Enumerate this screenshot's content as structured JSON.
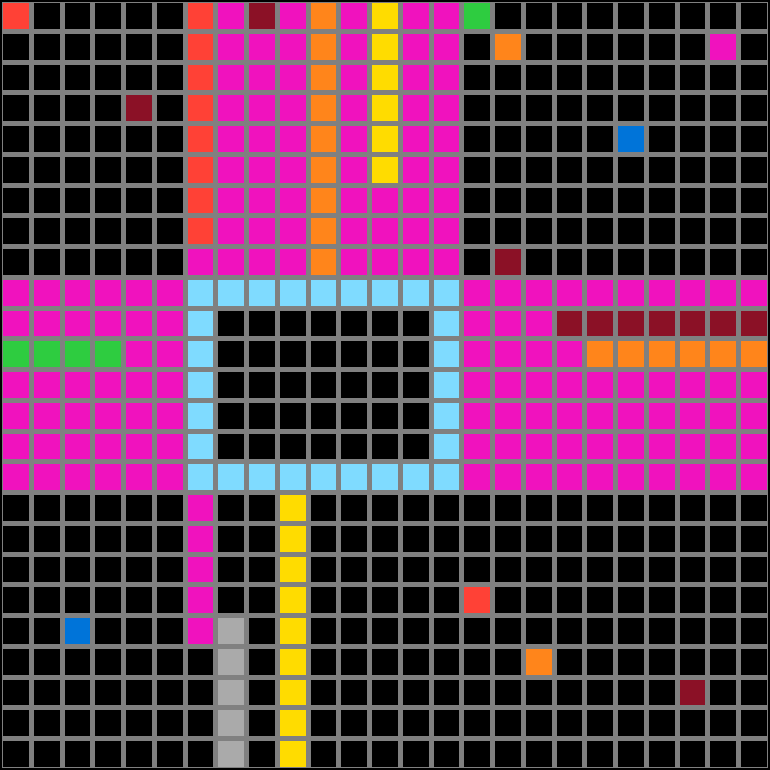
{
  "grid": {
    "columns": 25,
    "rows": 25,
    "line_color": "#808080",
    "outer_edge_color": "#000000",
    "palette": {
      "K": {
        "name": "black",
        "hex": "#000000"
      },
      "M": {
        "name": "magenta",
        "hex": "#F012BE"
      },
      "R": {
        "name": "red",
        "hex": "#FF4136"
      },
      "D": {
        "name": "dark-red",
        "hex": "#8B1126"
      },
      "O": {
        "name": "orange",
        "hex": "#FF851B"
      },
      "Y": {
        "name": "yellow",
        "hex": "#FFDC00"
      },
      "G": {
        "name": "green",
        "hex": "#2ECC40"
      },
      "B": {
        "name": "blue",
        "hex": "#0074D9"
      },
      "A": {
        "name": "light-blue",
        "hex": "#7FDBFF"
      },
      "S": {
        "name": "gray",
        "hex": "#AAAAAA"
      }
    },
    "cells": [
      "RKKKKKRMDMOMYMMGKKKKKKKKK",
      "KKKKKKRMMMOMYMMKOKKKKKKMK",
      "KKKKKKRMMMOMYMMKKKKKKKKKK",
      "KKKKDKRMMMOMYMMKKKKKKKKKK",
      "KKKKKKRMMMOMYMMKKKKKBKKKK",
      "KKKKKKRMMMOMYMMKKKKKKKKKK",
      "KKKKKKRMMMOMMMMKKKKKKKKKK",
      "KKKKKKRMMMOMMMMKKKKKKKKKK",
      "KKKKKKMMMMOMMMMKDKKKKKKKK",
      "MMMMMMAAAAAAAAAMMMMMMMMMM",
      "MMMMMMAKKKKKKKAMMMDDDDDDD",
      "GGGGMMAKKKKKKKAMMMMOOOOOO",
      "MMMMMMAKKKKKKKAMMMMMMMMMM",
      "MMMMMMAKKKKKKKAMMMMMMMMMM",
      "MMMMMMAKKKKKKKAMMMMMMMMMM",
      "MMMMMMAAAAAAAAAMMMMMMMMMM",
      "KKKKKKMKKYKKKKKKKKKKKKKKK",
      "KKKKKKMKKYKKKKKKKKKKKKKKK",
      "KKKKKKMKKYKKKKKKKKKKKKKKK",
      "KKKKKKMKKYKKKKKRKKKKKKKKK",
      "KKBKKKMSKYKKKKKKKKKKKKKKK",
      "KKKKKKKSKYKKKKKKKOKKKKKKK",
      "KKKKKKKSKYKKKKKKKKKKKKDKK",
      "KKKKKKKSKYKKKKKKKKKKKKKKK",
      "KKKKKKKSKYKKKKKKKKKKKKKKK"
    ]
  }
}
